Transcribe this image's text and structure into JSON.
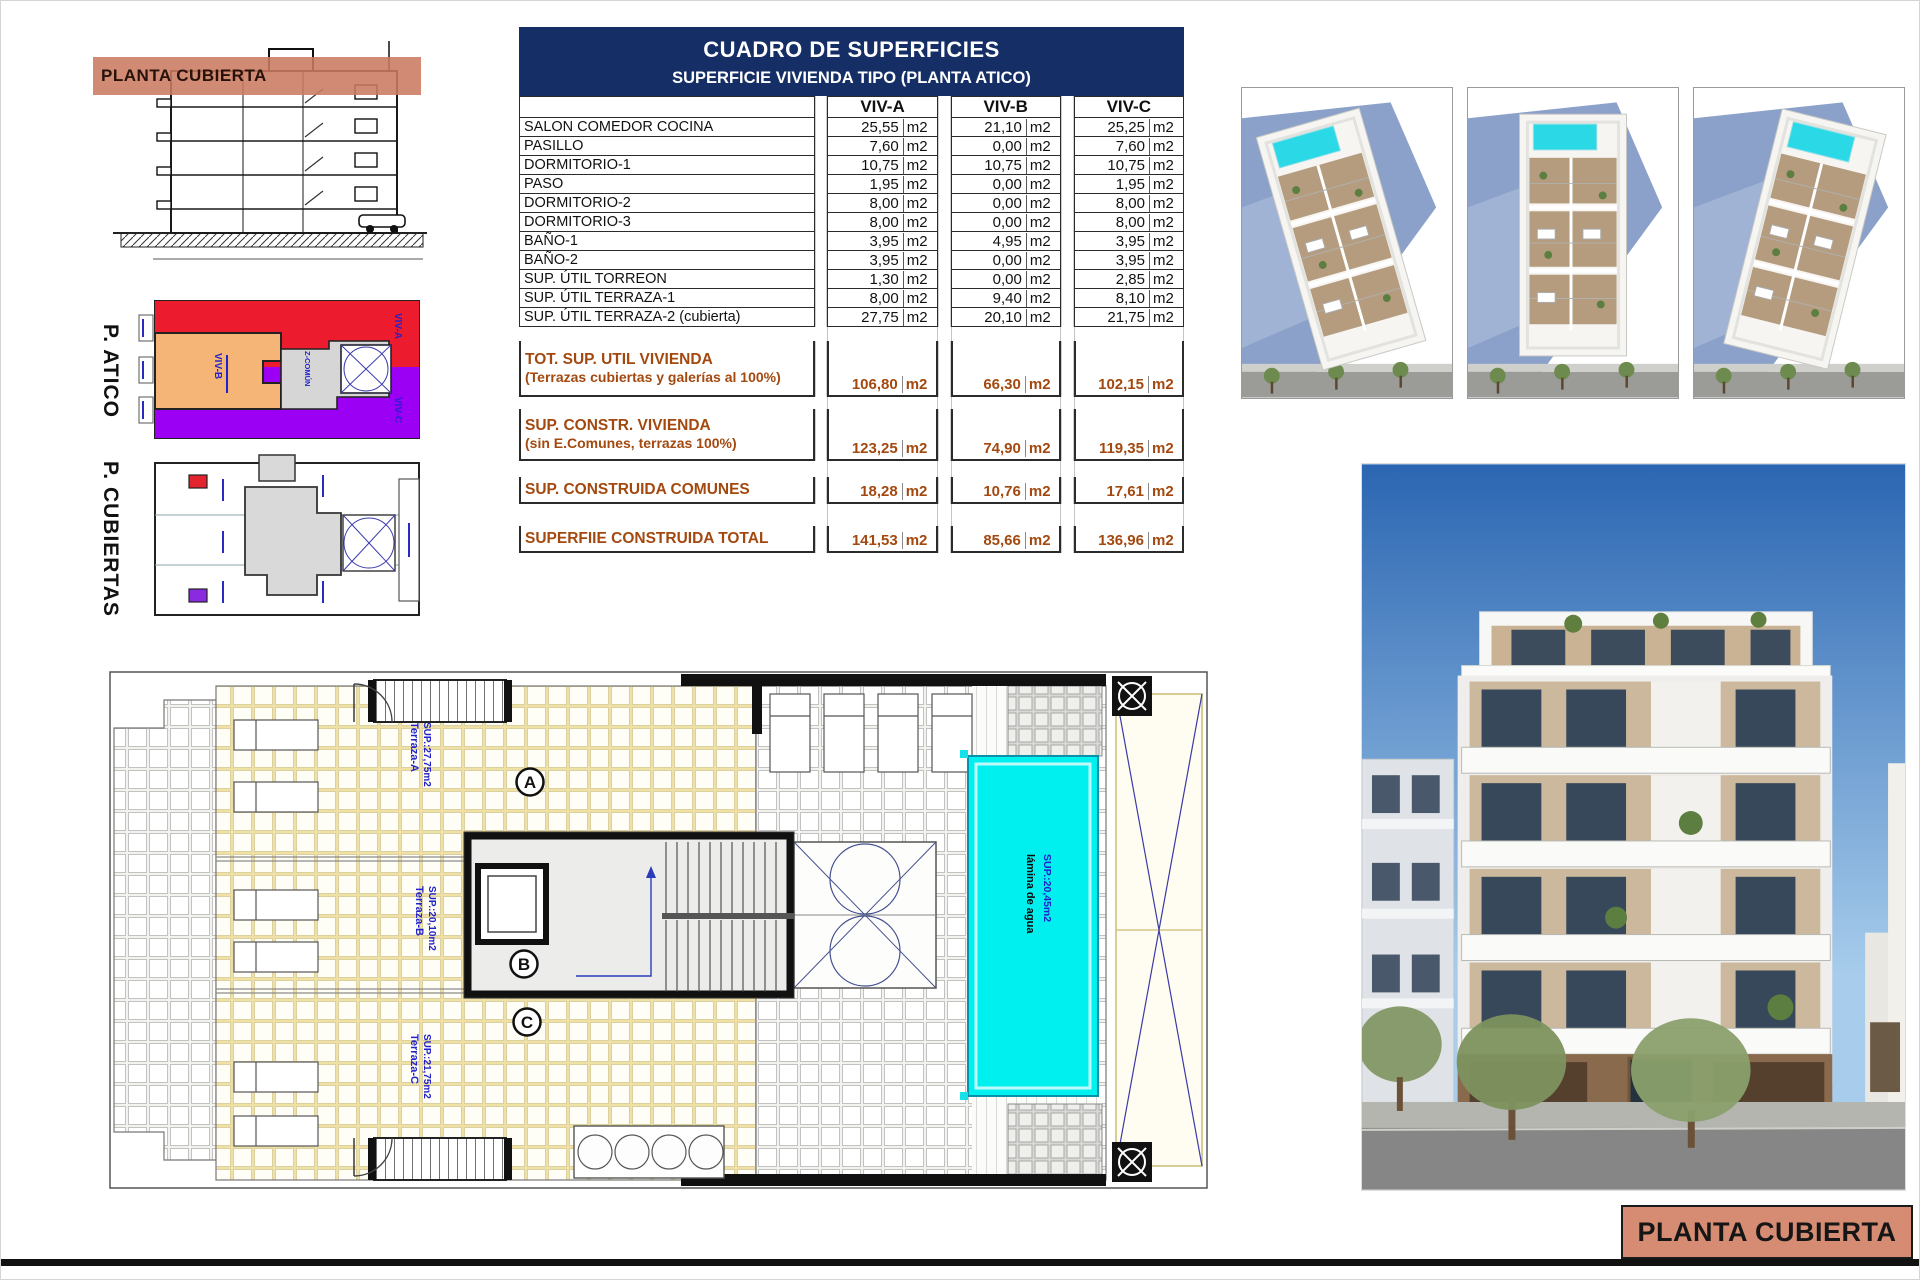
{
  "sheet": {
    "footer_label": "PLANTA CUBIERTA"
  },
  "section": {
    "band_label": "PLANTA CUBIERTA"
  },
  "atico": {
    "title": "P. ATICO",
    "zones": [
      {
        "label": "VIV-A",
        "color": "#ec1c2e"
      },
      {
        "label": "VIV-B",
        "color": "#f5b577"
      },
      {
        "label": "VIV-C",
        "color": "#9b00f5"
      },
      {
        "label": "Z-COMÚN",
        "color": "#d6d6d6"
      }
    ]
  },
  "cubiertas": {
    "title": "P. CUBIERTAS"
  },
  "table": {
    "title": "CUADRO DE SUPERFICIES",
    "subtitle": "SUPERFICIE VIVIENDA TIPO  (PLANTA ATICO)",
    "unit": "m2",
    "columns": [
      "VIV-A",
      "VIV-B",
      "VIV-C"
    ],
    "rows": [
      {
        "label": "SALON COMEDOR COCINA",
        "values": [
          "25,55",
          "21,10",
          "25,25"
        ]
      },
      {
        "label": "PASILLO",
        "values": [
          "7,60",
          "0,00",
          "7,60"
        ]
      },
      {
        "label": "DORMITORIO-1",
        "values": [
          "10,75",
          "10,75",
          "10,75"
        ]
      },
      {
        "label": "PASO",
        "values": [
          "1,95",
          "0,00",
          "1,95"
        ]
      },
      {
        "label": "DORMITORIO-2",
        "values": [
          "8,00",
          "0,00",
          "8,00"
        ]
      },
      {
        "label": "DORMITORIO-3",
        "values": [
          "8,00",
          "0,00",
          "8,00"
        ]
      },
      {
        "label": "BAÑO-1",
        "values": [
          "3,95",
          "4,95",
          "3,95"
        ]
      },
      {
        "label": "BAÑO-2",
        "values": [
          "3,95",
          "0,00",
          "3,95"
        ]
      },
      {
        "label": "SUP. ÚTIL TORREON",
        "values": [
          "1,30",
          "0,00",
          "2,85"
        ]
      },
      {
        "label": "SUP. ÚTIL TERRAZA-1",
        "values": [
          "8,00",
          "9,40",
          "8,10"
        ]
      },
      {
        "label": "SUP. ÚTIL TERRAZA-2 (cubierta)",
        "values": [
          "27,75",
          "20,10",
          "21,75"
        ]
      }
    ],
    "summary_rows": [
      {
        "label": "TOT. SUP. UTIL VIVIENDA",
        "sublabel": "(Terrazas cubiertas y galerías al 100%)",
        "values": [
          "106,80",
          "66,30",
          "102,15"
        ],
        "tall": true
      },
      {
        "label": "SUP. CONSTR. VIVIENDA",
        "sublabel": "(sin E.Comunes, terrazas 100%)",
        "values": [
          "123,25",
          "74,90",
          "119,35"
        ],
        "tall": true
      },
      {
        "label": "SUP. CONSTRUIDA COMUNES",
        "sublabel": "",
        "values": [
          "18,28",
          "10,76",
          "17,61"
        ],
        "tall": false
      },
      {
        "label": "SUPERFIIE CONSTRUIDA TOTAL",
        "sublabel": "",
        "values": [
          "141,53",
          "85,66",
          "136,96"
        ],
        "tall": false
      }
    ]
  },
  "floorplan": {
    "terrazas": [
      {
        "name": "Terraza-A",
        "sup": "SUP.:27,75m2"
      },
      {
        "name": "Terraza-B",
        "sup": "SUP.:20,10m2"
      },
      {
        "name": "Terraza-C",
        "sup": "SUP.:21,75m2"
      }
    ],
    "pool": {
      "name": "lámina de agua",
      "sup": "SUP.:20,45m2"
    },
    "stair_letters": [
      "A",
      "B",
      "C"
    ]
  },
  "colors": {
    "table_header_navy": "#152f66",
    "table_summary_brown": "#a3490f",
    "label_salmon": "#d68c72",
    "pool_cyan": "#00f0f0",
    "annotation_blue": "#2222cc",
    "zone_red": "#ec1c2e",
    "zone_orange": "#f5b577",
    "zone_purple": "#9b00f5",
    "zone_gray": "#d6d6d6"
  }
}
